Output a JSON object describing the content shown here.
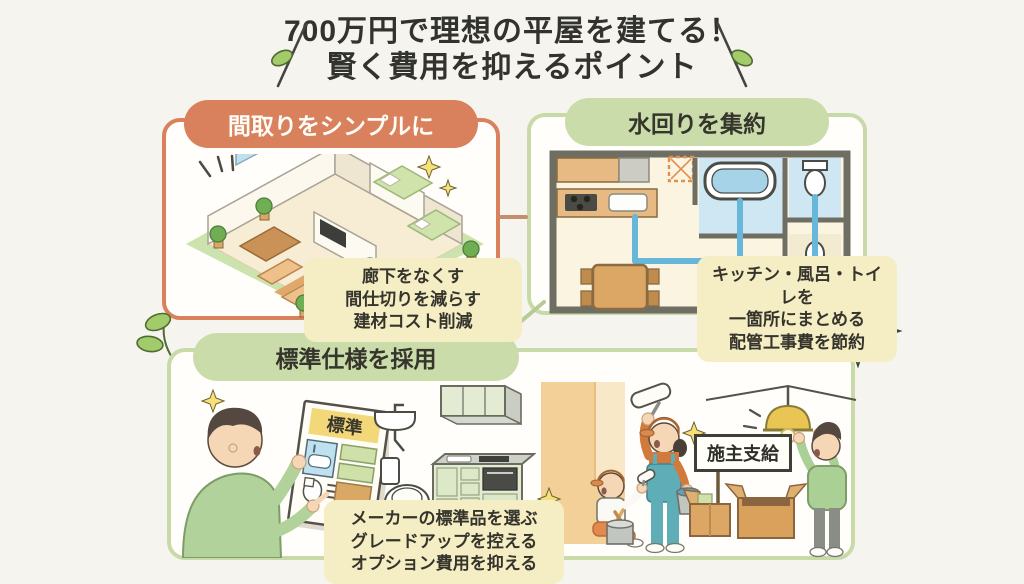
{
  "title": {
    "line1": "700万円で理想の平屋を建てる！",
    "line2": "賢く費用を抑えるポイント"
  },
  "panels": {
    "floorplan": {
      "header": "間取りをシンプルに",
      "callout": [
        "廊下をなくす",
        "間仕切りを減らす",
        "建材コスト削減"
      ]
    },
    "plumbing": {
      "header": "水回りを集約",
      "callout": [
        "キッチン・風呂・トイレを",
        "一箇所にまとめる",
        "配管工事費を節約"
      ]
    },
    "standard": {
      "header": "標準仕様を採用",
      "callout": [
        "メーカーの標準品を選ぶ",
        "グレードアップを控える",
        "オプション費用を抑える"
      ],
      "catalog_label": "標準",
      "sign_label": "施主支給"
    }
  },
  "colors": {
    "accent_orange": "#d9815c",
    "accent_green": "#c9daa9",
    "pill_green_bg": "#cbdcab",
    "callout_yellow": "#f5edc3",
    "pipe_blue": "#66b7da",
    "text_dark": "#32322e",
    "background": "#f6f4ef"
  }
}
